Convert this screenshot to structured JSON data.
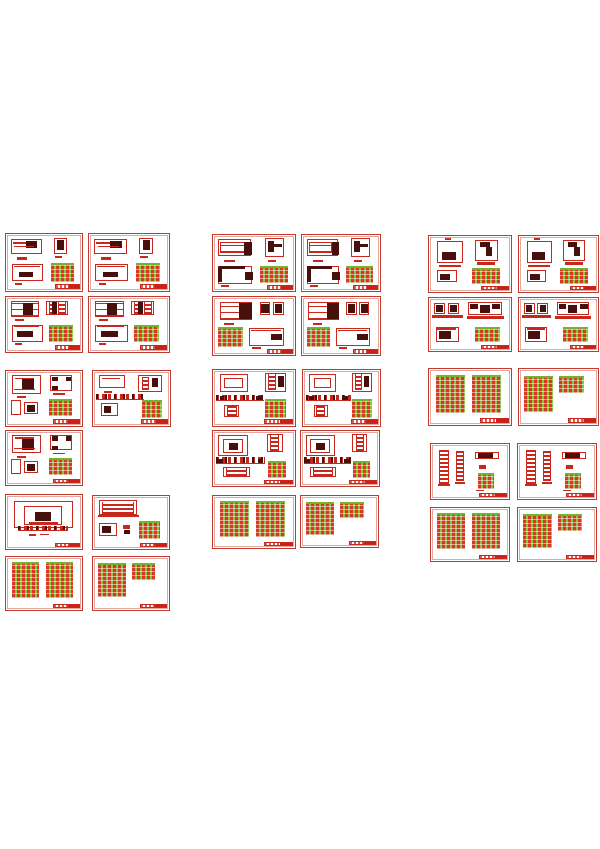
{
  "page": {
    "background": "#ffffff",
    "width": 600,
    "height": 849
  },
  "palette": {
    "page-bg": "#ffffff",
    "paper": "#ffffff",
    "sheet-border": "#c23a2c",
    "line-red": "#c8271e",
    "dark-ink": "#47100c",
    "table-green": "#8bc53f",
    "table-red": "#d63826",
    "table-grid": "#ffffff80",
    "table-cap": "#76b232",
    "title-red": "#cc2015",
    "title-dash": "#d8594d"
  },
  "collage": {
    "columns": 3,
    "sheet_count": 31,
    "layouts": {
      "LA": [
        [
          "frame",
          6,
          9,
          42,
          26
        ],
        [
          "bar",
          9,
          14,
          32,
          3
        ],
        [
          "blob",
          26,
          12,
          15,
          13
        ],
        [
          "bar",
          11,
          21,
          26,
          2
        ],
        [
          "bar",
          15,
          40,
          13,
          5
        ],
        [
          "frame",
          63,
          7,
          17,
          28
        ],
        [
          "blob",
          67,
          10,
          9,
          18
        ],
        [
          "bar",
          64,
          39,
          10,
          4
        ],
        [
          "frame",
          8,
          53,
          41,
          30
        ],
        [
          "bar",
          10,
          56,
          35,
          2
        ],
        [
          "blob",
          17,
          66,
          19,
          10
        ],
        [
          "bar",
          12,
          86,
          9,
          3
        ],
        [
          "table",
          59,
          51,
          30,
          33
        ],
        [
          "title",
          64,
          88,
          33,
          9
        ]
      ],
      "LA2": [
        [
          "frame",
          6,
          8,
          40,
          30
        ],
        [
          "hstripes",
          9,
          12,
          30,
          20
        ],
        [
          "blob",
          38,
          12,
          10,
          24
        ],
        [
          "bar",
          14,
          44,
          13,
          4
        ],
        [
          "frame",
          63,
          6,
          24,
          34
        ],
        [
          "blob",
          67,
          10,
          7,
          20
        ],
        [
          "blob",
          74,
          16,
          10,
          6
        ],
        [
          "bar",
          67,
          44,
          10,
          4
        ],
        [
          "frame",
          6,
          56,
          42,
          32
        ],
        [
          "blob",
          7,
          56,
          32,
          5
        ],
        [
          "blob",
          6,
          58,
          5,
          26
        ],
        [
          "blob",
          39,
          66,
          10,
          15
        ],
        [
          "bar",
          10,
          90,
          10,
          3
        ],
        [
          "table",
          57,
          56,
          34,
          30
        ],
        [
          "title",
          66,
          90,
          31,
          8
        ]
      ],
      "LB": [
        [
          "hstripes",
          7,
          8,
          37,
          28
        ],
        [
          "blob",
          22,
          11,
          13,
          22
        ],
        [
          "bar",
          12,
          40,
          12,
          4
        ],
        [
          "frame",
          53,
          7,
          28,
          26
        ],
        [
          "vladder",
          56,
          9,
          10,
          22
        ],
        [
          "vladder",
          69,
          9,
          10,
          22
        ],
        [
          "blob",
          61,
          9,
          6,
          22
        ],
        [
          "frame",
          8,
          50,
          41,
          32
        ],
        [
          "bar",
          10,
          53,
          34,
          2
        ],
        [
          "blob",
          15,
          62,
          21,
          11
        ],
        [
          "bar",
          12,
          84,
          9,
          3
        ],
        [
          "table",
          56,
          50,
          32,
          32
        ],
        [
          "title",
          64,
          88,
          33,
          9
        ]
      ],
      "LB2": [
        [
          "hstripes",
          8,
          8,
          40,
          32
        ],
        [
          "blob",
          32,
          10,
          15,
          28
        ],
        [
          "bar",
          14,
          44,
          12,
          4
        ],
        [
          "frame",
          57,
          8,
          13,
          23
        ],
        [
          "frame",
          73,
          8,
          13,
          23
        ],
        [
          "blob",
          59,
          12,
          9,
          15
        ],
        [
          "blob",
          75,
          12,
          9,
          15
        ],
        [
          "table",
          6,
          52,
          30,
          34
        ],
        [
          "frame",
          44,
          54,
          43,
          30
        ],
        [
          "bar",
          46,
          57,
          37,
          2
        ],
        [
          "blob",
          71,
          64,
          13,
          11
        ],
        [
          "bar",
          48,
          86,
          10,
          3
        ],
        [
          "title",
          66,
          90,
          31,
          8
        ]
      ],
      "LC": [
        [
          "frame",
          8,
          8,
          38,
          33
        ],
        [
          "blob",
          21,
          14,
          16,
          21
        ],
        [
          "bar",
          12,
          12,
          25,
          2
        ],
        [
          "bar",
          10,
          32,
          28,
          2
        ],
        [
          "bar",
          14,
          46,
          12,
          4
        ],
        [
          "frame",
          58,
          8,
          29,
          28
        ],
        [
          "blob",
          60,
          10,
          8,
          9
        ],
        [
          "blob",
          79,
          10,
          6,
          9
        ],
        [
          "blob",
          60,
          27,
          8,
          8
        ],
        [
          "bar",
          62,
          40,
          16,
          3
        ],
        [
          "frame",
          6,
          52,
          14,
          28
        ],
        [
          "frame",
          24,
          56,
          18,
          22
        ],
        [
          "blob",
          28,
          62,
          10,
          13
        ],
        [
          "table",
          57,
          50,
          30,
          32
        ],
        [
          "title",
          62,
          88,
          35,
          9
        ]
      ],
      "LD": [
        [
          "frame",
          8,
          8,
          33,
          23
        ],
        [
          "bar",
          12,
          13,
          23,
          2
        ],
        [
          "bar",
          14,
          36,
          11,
          4
        ],
        [
          "frame",
          59,
          8,
          30,
          31
        ],
        [
          "vladder",
          63,
          10,
          10,
          25
        ],
        [
          "blob",
          77,
          12,
          8,
          17
        ],
        [
          "hdashes",
          4,
          42,
          62,
          11
        ],
        [
          "frame",
          10,
          58,
          22,
          24
        ],
        [
          "blob",
          14,
          64,
          10,
          13
        ],
        [
          "table",
          63,
          52,
          26,
          33
        ],
        [
          "title",
          62,
          88,
          35,
          9
        ]
      ],
      "LD2": [
        [
          "frame",
          8,
          8,
          35,
          31
        ],
        [
          "frame",
          14,
          14,
          23,
          19
        ],
        [
          "frame",
          63,
          6,
          26,
          33
        ],
        [
          "vladder",
          67,
          8,
          10,
          27
        ],
        [
          "blob",
          79,
          10,
          7,
          20
        ],
        [
          "hdashes",
          4,
          44,
          58,
          11
        ],
        [
          "blob",
          8,
          46,
          6,
          8
        ],
        [
          "blob",
          52,
          46,
          6,
          8
        ],
        [
          "frame",
          14,
          62,
          18,
          22
        ],
        [
          "vladder",
          17,
          64,
          12,
          18
        ],
        [
          "table",
          63,
          52,
          26,
          33
        ],
        [
          "title",
          62,
          88,
          35,
          9
        ]
      ],
      "LE": [
        [
          "frame",
          10,
          12,
          78,
          50
        ],
        [
          "frame",
          24,
          20,
          50,
          36
        ],
        [
          "blob",
          38,
          32,
          21,
          17
        ],
        [
          "bar",
          30,
          50,
          38,
          6
        ],
        [
          "hdashes",
          16,
          58,
          66,
          8
        ],
        [
          "bar",
          30,
          72,
          10,
          4
        ],
        [
          "mark",
          45,
          72,
          12,
          3
        ],
        [
          "title",
          64,
          88,
          33,
          9
        ]
      ],
      "LE2": [
        [
          "frame",
          6,
          8,
          37,
          38
        ],
        [
          "frame",
          12,
          15,
          25,
          25
        ],
        [
          "blob",
          19,
          21,
          12,
          13
        ],
        [
          "frame",
          66,
          6,
          19,
          32
        ],
        [
          "vladder",
          70,
          8,
          11,
          28
        ],
        [
          "hdashes",
          4,
          48,
          60,
          12
        ],
        [
          "blob",
          6,
          50,
          6,
          8
        ],
        [
          "blob",
          55,
          50,
          6,
          8
        ],
        [
          "frame",
          12,
          66,
          33,
          18
        ],
        [
          "vladder",
          16,
          68,
          25,
          14
        ],
        [
          "table",
          67,
          54,
          22,
          32
        ],
        [
          "title",
          62,
          89,
          35,
          8
        ]
      ],
      "LF": [
        [
          "frame",
          8,
          8,
          50,
          28
        ],
        [
          "vladder",
          12,
          11,
          42,
          23
        ],
        [
          "bar",
          6,
          36,
          54,
          4
        ],
        [
          "frame",
          8,
          50,
          24,
          25
        ],
        [
          "blob",
          12,
          56,
          12,
          13
        ],
        [
          "mark",
          39,
          54,
          10,
          8
        ],
        [
          "blob",
          41,
          64,
          8,
          7
        ],
        [
          "table",
          60,
          48,
          28,
          34
        ],
        [
          "title",
          62,
          88,
          35,
          9
        ]
      ],
      "LG2": [
        [
          "table",
          8,
          10,
          36,
          68
        ],
        [
          "table",
          52,
          10,
          36,
          68
        ],
        [
          "title",
          62,
          88,
          35,
          9
        ]
      ],
      "LG2s": [
        [
          "table",
          6,
          12,
          37,
          64
        ],
        [
          "table",
          51,
          12,
          31,
          31
        ],
        [
          "title",
          62,
          88,
          35,
          9
        ]
      ],
      "LH": [
        [
          "bar",
          19,
          4,
          8,
          4
        ],
        [
          "frame",
          10,
          9,
          32,
          40
        ],
        [
          "blob",
          16,
          28,
          17,
          15
        ],
        [
          "bar",
          12,
          51,
          27,
          5
        ],
        [
          "frame",
          56,
          7,
          28,
          38
        ],
        [
          "blob",
          62,
          11,
          12,
          8
        ],
        [
          "blob",
          69,
          19,
          8,
          16
        ],
        [
          "bar",
          58,
          47,
          23,
          5
        ],
        [
          "frame",
          10,
          61,
          24,
          22
        ],
        [
          "blob",
          14,
          67,
          12,
          11
        ],
        [
          "table",
          52,
          58,
          35,
          28
        ],
        [
          "title",
          64,
          89,
          33,
          8
        ]
      ],
      "LI": [
        [
          "frame",
          6,
          10,
          14,
          21
        ],
        [
          "frame",
          23,
          10,
          14,
          21
        ],
        [
          "blob",
          9,
          14,
          8,
          13
        ],
        [
          "blob",
          26,
          14,
          8,
          13
        ],
        [
          "bar",
          4,
          32,
          37,
          5
        ],
        [
          "frame",
          48,
          8,
          41,
          25
        ],
        [
          "blob",
          50,
          11,
          10,
          10
        ],
        [
          "blob",
          77,
          11,
          10,
          10
        ],
        [
          "blob",
          62,
          13,
          12,
          15
        ],
        [
          "bar",
          46,
          34,
          45,
          5
        ],
        [
          "frame",
          8,
          54,
          28,
          29
        ],
        [
          "bar",
          10,
          57,
          23,
          3
        ],
        [
          "blob",
          12,
          62,
          15,
          15
        ],
        [
          "smalltable",
          56,
          54,
          31,
          29
        ],
        [
          "title",
          64,
          89,
          33,
          8
        ]
      ],
      "LJ": [
        [
          "vladder",
          10,
          10,
          13,
          62
        ],
        [
          "bar",
          9,
          73,
          15,
          4
        ],
        [
          "vladder",
          32,
          12,
          10,
          56
        ],
        [
          "bar",
          31,
          69,
          12,
          3
        ],
        [
          "frame",
          56,
          14,
          31,
          14
        ],
        [
          "blob",
          60,
          17,
          19,
          8
        ],
        [
          "mark",
          61,
          38,
          10,
          8
        ],
        [
          "smalltable",
          60,
          52,
          21,
          29
        ],
        [
          "bar",
          58,
          83,
          10,
          3
        ],
        [
          "title",
          62,
          89,
          35,
          8
        ]
      ]
    },
    "sheets": [
      {
        "x": 5,
        "y": 233,
        "w": 78,
        "h": 59,
        "layout": "LA"
      },
      {
        "x": 88,
        "y": 233,
        "w": 82,
        "h": 59,
        "layout": "LA"
      },
      {
        "x": 5,
        "y": 296,
        "w": 78,
        "h": 57,
        "layout": "LB"
      },
      {
        "x": 88,
        "y": 296,
        "w": 82,
        "h": 57,
        "layout": "LB"
      },
      {
        "x": 5,
        "y": 370,
        "w": 78,
        "h": 57,
        "layout": "LC"
      },
      {
        "x": 92,
        "y": 370,
        "w": 79,
        "h": 57,
        "layout": "LD"
      },
      {
        "x": 5,
        "y": 430,
        "w": 78,
        "h": 56,
        "layout": "LC"
      },
      {
        "x": 5,
        "y": 494,
        "w": 78,
        "h": 56,
        "layout": "LE"
      },
      {
        "x": 92,
        "y": 495,
        "w": 78,
        "h": 55,
        "layout": "LF"
      },
      {
        "x": 5,
        "y": 556,
        "w": 78,
        "h": 55,
        "layout": "LG2"
      },
      {
        "x": 92,
        "y": 556,
        "w": 78,
        "h": 55,
        "layout": "LG2s"
      },
      {
        "x": 212,
        "y": 234,
        "w": 84,
        "h": 58,
        "layout": "LA2"
      },
      {
        "x": 301,
        "y": 234,
        "w": 80,
        "h": 58,
        "layout": "LA2"
      },
      {
        "x": 212,
        "y": 296,
        "w": 84,
        "h": 60,
        "layout": "LB2"
      },
      {
        "x": 301,
        "y": 296,
        "w": 80,
        "h": 60,
        "layout": "LB2"
      },
      {
        "x": 212,
        "y": 369,
        "w": 84,
        "h": 58,
        "layout": "LD2"
      },
      {
        "x": 302,
        "y": 369,
        "w": 79,
        "h": 58,
        "layout": "LD2"
      },
      {
        "x": 212,
        "y": 430,
        "w": 84,
        "h": 57,
        "layout": "LE2"
      },
      {
        "x": 300,
        "y": 430,
        "w": 80,
        "h": 57,
        "layout": "LE2"
      },
      {
        "x": 212,
        "y": 495,
        "w": 84,
        "h": 54,
        "layout": "LG2"
      },
      {
        "x": 300,
        "y": 495,
        "w": 79,
        "h": 53,
        "layout": "LG2s"
      },
      {
        "x": 428,
        "y": 235,
        "w": 84,
        "h": 58,
        "layout": "LH"
      },
      {
        "x": 518,
        "y": 235,
        "w": 81,
        "h": 58,
        "layout": "LH"
      },
      {
        "x": 428,
        "y": 297,
        "w": 84,
        "h": 55,
        "layout": "LI"
      },
      {
        "x": 518,
        "y": 297,
        "w": 81,
        "h": 55,
        "layout": "LI"
      },
      {
        "x": 428,
        "y": 368,
        "w": 84,
        "h": 58,
        "layout": "LG2"
      },
      {
        "x": 518,
        "y": 368,
        "w": 81,
        "h": 58,
        "layout": "LG2s"
      },
      {
        "x": 430,
        "y": 443,
        "w": 80,
        "h": 57,
        "layout": "LJ"
      },
      {
        "x": 517,
        "y": 443,
        "w": 80,
        "h": 57,
        "layout": "LJ"
      },
      {
        "x": 430,
        "y": 507,
        "w": 80,
        "h": 55,
        "layout": "LG2"
      },
      {
        "x": 517,
        "y": 507,
        "w": 80,
        "h": 55,
        "layout": "LG2s"
      }
    ]
  }
}
